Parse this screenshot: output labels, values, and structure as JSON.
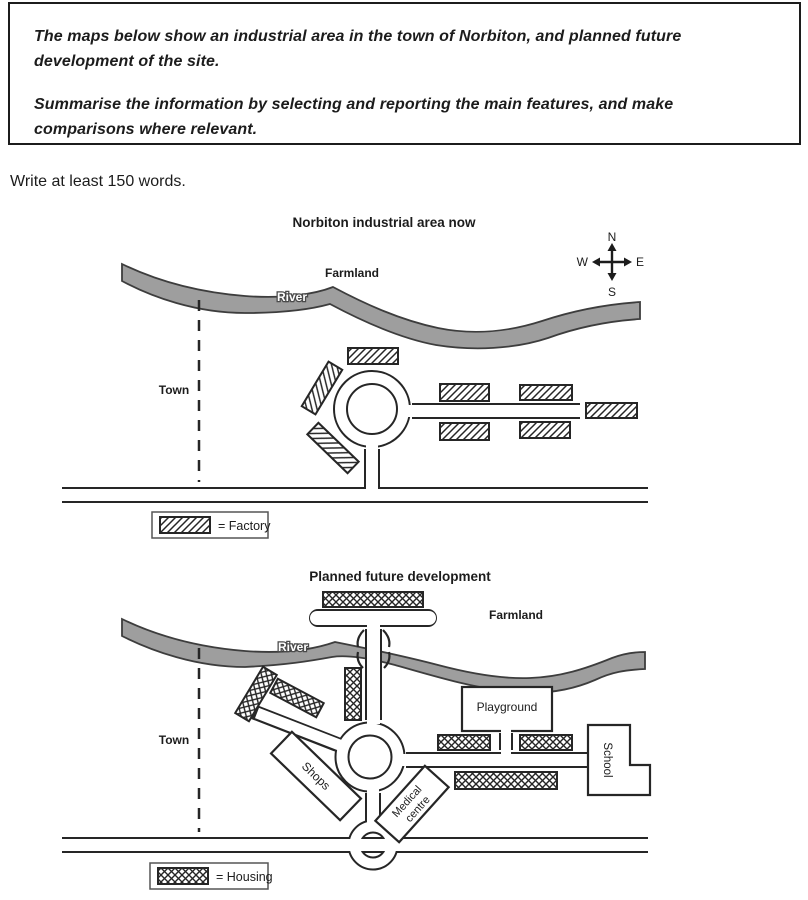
{
  "task": {
    "instructions": [
      "The maps below show an industrial area in the town of Norbiton, and planned future development of the site.",
      "Summarise the information by selecting and reporting the main features, and make comparisons where relevant."
    ],
    "word_requirement": "Write at least 150 words."
  },
  "colors": {
    "ink": "#262626",
    "river_fill": "#9e9e9e",
    "paper": "#ffffff"
  },
  "compass": {
    "north": "N",
    "east": "E",
    "south": "S",
    "west": "W"
  },
  "map_now": {
    "title": "Norbiton industrial area now",
    "labels": {
      "farmland": "Farmland",
      "river": "River",
      "town": "Town"
    },
    "legend": {
      "symbol": "diagonal-hatch-swatch",
      "label": "= Factory"
    }
  },
  "map_future": {
    "title": "Planned future development",
    "labels": {
      "farmland": "Farmland",
      "river": "River",
      "town": "Town",
      "playground": "Playground",
      "school": "School",
      "shops": "Shops",
      "medical_line1": "Medical",
      "medical_line2": "centre"
    },
    "legend": {
      "symbol": "cross-hatch-swatch",
      "label": "= Housing"
    }
  }
}
